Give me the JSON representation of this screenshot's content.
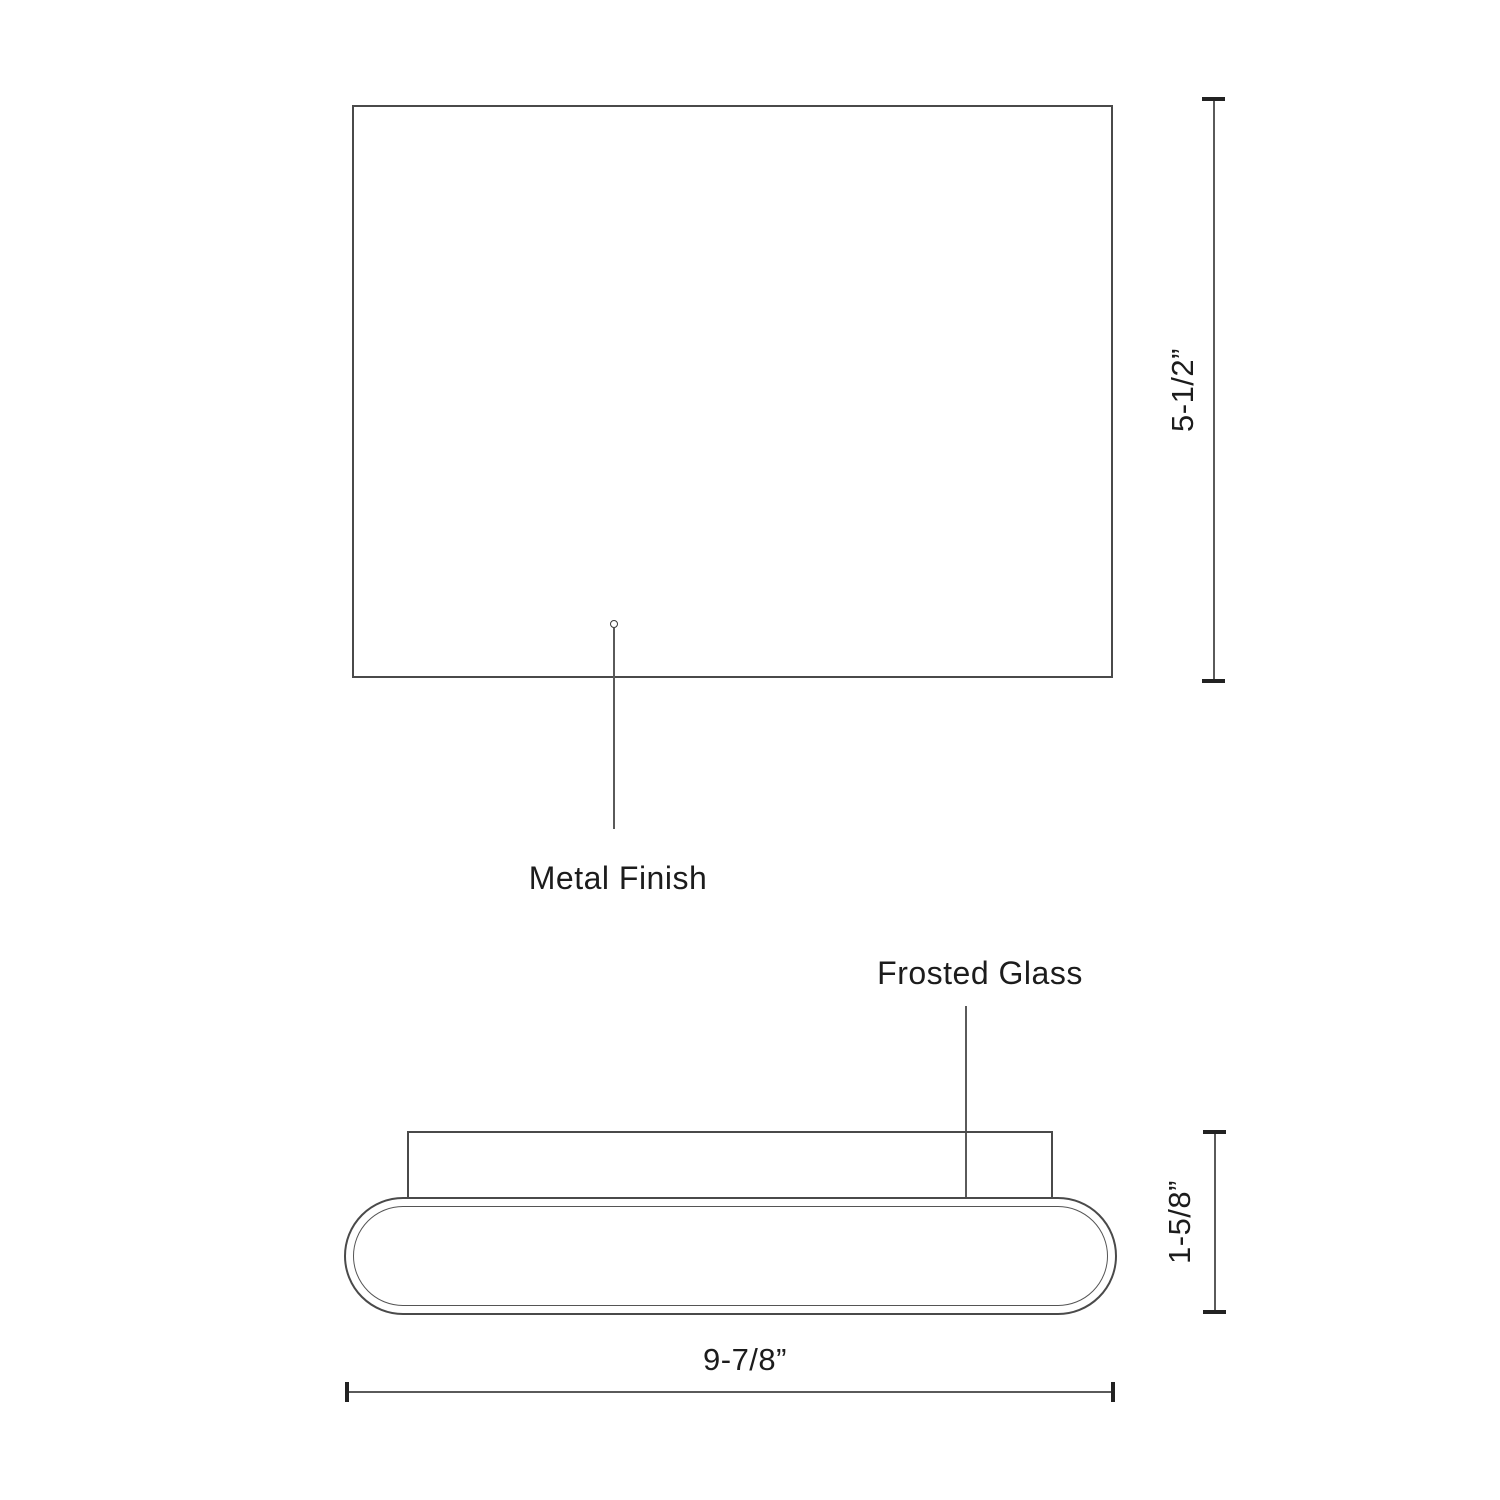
{
  "colors": {
    "background": "#ffffff",
    "line": "#4a4a4a",
    "tick": "#222222",
    "text": "#1c1c1c"
  },
  "drawing": {
    "callouts": {
      "metal_finish": {
        "label": "Metal Finish"
      },
      "frosted_glass": {
        "label": "Frosted Glass"
      }
    },
    "dimensions": {
      "front_height": {
        "value": "5-1/2”"
      },
      "side_height": {
        "value": "1-5/8”"
      },
      "side_width": {
        "value": "9-7/8”"
      }
    }
  }
}
